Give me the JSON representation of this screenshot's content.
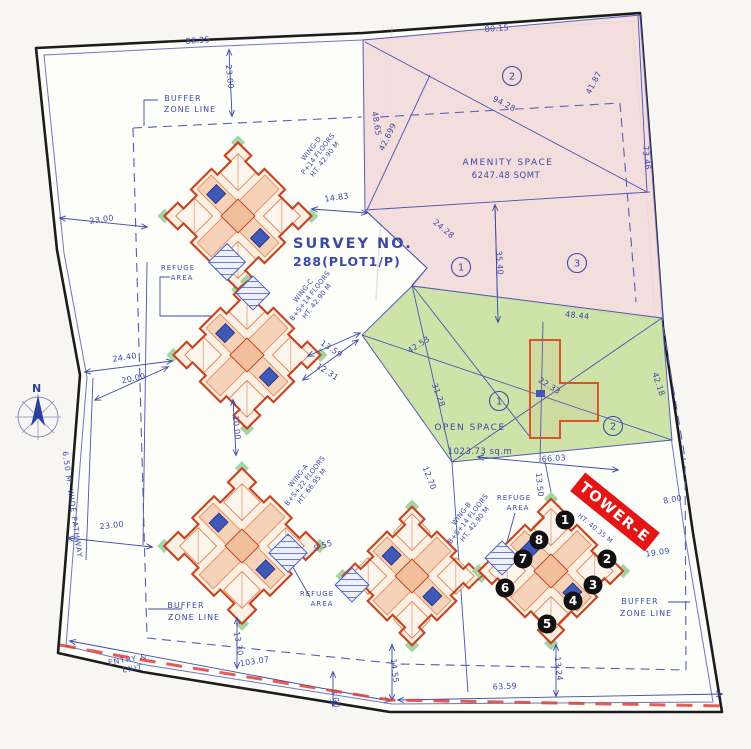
{
  "title": {
    "survey_line1": "SURVEY NO.",
    "survey_line2": "288(PLOT1/P)"
  },
  "north_label": "N",
  "colors": {
    "boundary_black": "#1c1c1c",
    "survey_blue": "#3c4aa5",
    "pink_zone": "#f3dcdc",
    "green_zone": "#cbe2a4",
    "tower_outline": "#c7431f",
    "tower_fill": "#fcefe3",
    "tower_inner": "#e0824f",
    "core_blue": "#4058b8",
    "banner_red": "#e51515",
    "dashed_red": "#e04038",
    "marker_black": "#111111",
    "paper": "#fdfdfa"
  },
  "areas": {
    "amenity": {
      "name": "AMENITY SPACE",
      "value": "6247.48 SQMT",
      "zones": [
        {
          "n": "2",
          "x": 512,
          "y": 76
        },
        {
          "n": "1",
          "x": 461,
          "y": 267
        },
        {
          "n": "3",
          "x": 577,
          "y": 263
        }
      ]
    },
    "open": {
      "name": "OPEN SPACE",
      "value": "1023.73 sq.m",
      "zones": [
        {
          "n": "1",
          "x": 499,
          "y": 401
        },
        {
          "n": "2",
          "x": 613,
          "y": 426
        }
      ]
    }
  },
  "tower_e": {
    "banner": "TOWER-E",
    "sub": "HT. 40.35 M"
  },
  "towers": [
    {
      "id": "wing-d",
      "cx": 238,
      "cy": 216,
      "s": 104
    },
    {
      "id": "wing-c",
      "cx": 247,
      "cy": 355,
      "s": 104
    },
    {
      "id": "wing-a",
      "cx": 242,
      "cy": 546,
      "s": 110
    },
    {
      "id": "wing-b",
      "cx": 412,
      "cy": 576,
      "s": 98
    },
    {
      "id": "wing-e",
      "cx": 551,
      "cy": 571,
      "s": 102
    }
  ],
  "wing_labels": [
    {
      "lines": [
        "WING-D",
        "P+14 FLOORS",
        "HT. 42.90 M"
      ],
      "x": 313,
      "y": 150,
      "r": -52
    },
    {
      "lines": [
        "WING-C",
        "B+S+14 FLOORS",
        "HT. 42.90 M"
      ],
      "x": 305,
      "y": 292,
      "r": -52
    },
    {
      "lines": [
        "WING-A",
        "B+S+22 FLOORS",
        "HT. 66.95 M"
      ],
      "x": 300,
      "y": 477,
      "r": -52
    },
    {
      "lines": [
        "WING-B",
        "B+S+14 FLOORS",
        "HT. 42.90 M"
      ],
      "x": 463,
      "y": 515,
      "r": -52
    }
  ],
  "markers": [
    {
      "n": "1",
      "x": 565,
      "y": 520
    },
    {
      "n": "2",
      "x": 607,
      "y": 559
    },
    {
      "n": "3",
      "x": 593,
      "y": 585
    },
    {
      "n": "4",
      "x": 573,
      "y": 601
    },
    {
      "n": "5",
      "x": 547,
      "y": 624
    },
    {
      "n": "6",
      "x": 505,
      "y": 588
    },
    {
      "n": "7",
      "x": 523,
      "y": 559
    },
    {
      "n": "8",
      "x": 539,
      "y": 540
    }
  ],
  "hatches": [
    {
      "x": 227,
      "y": 262,
      "s": 26
    },
    {
      "x": 253,
      "y": 293,
      "s": 24
    },
    {
      "x": 288,
      "y": 553,
      "s": 27
    },
    {
      "x": 352,
      "y": 585,
      "s": 24
    },
    {
      "x": 502,
      "y": 558,
      "s": 24
    }
  ],
  "dimensions": [
    {
      "t": "80.15",
      "x": 497,
      "y": 31,
      "r": -4
    },
    {
      "t": "88.35",
      "x": 198,
      "y": 43,
      "r": -4
    },
    {
      "t": "23.00",
      "x": 227,
      "y": 77,
      "r": 84
    },
    {
      "t": "94.28",
      "x": 503,
      "y": 106,
      "r": 27
    },
    {
      "t": "41.87",
      "x": 596,
      "y": 84,
      "r": -62
    },
    {
      "t": "42.699",
      "x": 390,
      "y": 138,
      "r": -64
    },
    {
      "t": "48.65",
      "x": 374,
      "y": 124,
      "r": 80
    },
    {
      "t": "73.46",
      "x": 644,
      "y": 158,
      "r": 84
    },
    {
      "t": "14.83",
      "x": 337,
      "y": 200,
      "r": -8
    },
    {
      "t": "35.40",
      "x": 497,
      "y": 263,
      "r": 86
    },
    {
      "t": "24.28",
      "x": 442,
      "y": 231,
      "r": 40
    },
    {
      "t": "48.44",
      "x": 577,
      "y": 318,
      "r": 6
    },
    {
      "t": "23.00",
      "x": 102,
      "y": 222,
      "r": -8
    },
    {
      "t": "24.40",
      "x": 125,
      "y": 360,
      "r": -9
    },
    {
      "t": "20.00",
      "x": 134,
      "y": 381,
      "r": -12
    },
    {
      "t": "23.00",
      "x": 112,
      "y": 528,
      "r": -6
    },
    {
      "t": "13.59",
      "x": 330,
      "y": 351,
      "r": 33
    },
    {
      "t": "12.31",
      "x": 326,
      "y": 374,
      "r": 33
    },
    {
      "t": "42.53",
      "x": 420,
      "y": 347,
      "r": -33
    },
    {
      "t": "31.28",
      "x": 436,
      "y": 396,
      "r": 70
    },
    {
      "t": "22.33",
      "x": 548,
      "y": 388,
      "r": 32
    },
    {
      "t": "12.70",
      "x": 427,
      "y": 479,
      "r": 68
    },
    {
      "t": "66.03",
      "x": 554,
      "y": 461,
      "r": -4
    },
    {
      "t": "13.50",
      "x": 537,
      "y": 485,
      "r": 84
    },
    {
      "t": "8.00",
      "x": 673,
      "y": 502,
      "r": -10
    },
    {
      "t": "19.09",
      "x": 658,
      "y": 555,
      "r": -8
    },
    {
      "t": "9.55",
      "x": 324,
      "y": 548,
      "r": -18
    },
    {
      "t": "10.00",
      "x": 234,
      "y": 428,
      "r": 84
    },
    {
      "t": "103.07",
      "x": 255,
      "y": 664,
      "r": -9
    },
    {
      "t": "13.30",
      "x": 236,
      "y": 644,
      "r": 80
    },
    {
      "t": "8.00",
      "x": 333,
      "y": 699,
      "r": 80
    },
    {
      "t": "14.55",
      "x": 392,
      "y": 671,
      "r": 84
    },
    {
      "t": "13.24",
      "x": 556,
      "y": 669,
      "r": 84
    },
    {
      "t": "63.59",
      "x": 505,
      "y": 689,
      "r": -3
    },
    {
      "t": "42.18",
      "x": 656,
      "y": 385,
      "r": 72
    }
  ],
  "labels": [
    {
      "t": "BUFFER",
      "x": 183,
      "y": 101,
      "s": 8
    },
    {
      "t": "ZONE LINE",
      "x": 190,
      "y": 112,
      "s": 8
    },
    {
      "t": "BUFFER",
      "x": 186,
      "y": 608,
      "s": 8
    },
    {
      "t": "ZONE LINE",
      "x": 194,
      "y": 620,
      "s": 8
    },
    {
      "t": "BUFFER",
      "x": 640,
      "y": 604,
      "s": 8
    },
    {
      "t": "ZONE LINE",
      "x": 646,
      "y": 616,
      "s": 8
    },
    {
      "t": "REFUGE",
      "x": 178,
      "y": 270,
      "s": 7
    },
    {
      "t": "AREA",
      "x": 182,
      "y": 280,
      "s": 7
    },
    {
      "t": "REFUGE",
      "x": 317,
      "y": 596,
      "s": 7
    },
    {
      "t": "AREA",
      "x": 322,
      "y": 606,
      "s": 7
    },
    {
      "t": "REFUGE",
      "x": 514,
      "y": 500,
      "s": 7
    },
    {
      "t": "AREA",
      "x": 518,
      "y": 510,
      "s": 7
    },
    {
      "t": "ENTRY &",
      "x": 128,
      "y": 662,
      "s": 7.5,
      "r": -9
    },
    {
      "t": "EXIT",
      "x": 133,
      "y": 671,
      "s": 7.5,
      "r": -9
    },
    {
      "t": "6.50 M. WIDE PATHWAY",
      "x": 70,
      "y": 505,
      "s": 7.5,
      "r": 82
    }
  ],
  "dim_lines": [
    {
      "x1": 312,
      "y1": 209,
      "x2": 367,
      "y2": 213
    },
    {
      "x1": 60,
      "y1": 218,
      "x2": 147,
      "y2": 227
    },
    {
      "x1": 229,
      "y1": 50,
      "x2": 232,
      "y2": 116
    },
    {
      "x1": 85,
      "y1": 372,
      "x2": 172,
      "y2": 361
    },
    {
      "x1": 95,
      "y1": 400,
      "x2": 168,
      "y2": 367
    },
    {
      "x1": 68,
      "y1": 538,
      "x2": 152,
      "y2": 547
    },
    {
      "x1": 478,
      "y1": 457,
      "x2": 618,
      "y2": 470
    },
    {
      "x1": 398,
      "y1": 700,
      "x2": 722,
      "y2": 694
    },
    {
      "x1": 70,
      "y1": 641,
      "x2": 390,
      "y2": 701
    },
    {
      "x1": 392,
      "y1": 645,
      "x2": 392,
      "y2": 700
    },
    {
      "x1": 333,
      "y1": 672,
      "x2": 333,
      "y2": 706
    },
    {
      "x1": 237,
      "y1": 618,
      "x2": 237,
      "y2": 668
    },
    {
      "x1": 556,
      "y1": 645,
      "x2": 556,
      "y2": 696
    },
    {
      "x1": 233,
      "y1": 400,
      "x2": 236,
      "y2": 455
    },
    {
      "x1": 495,
      "y1": 205,
      "x2": 498,
      "y2": 322
    },
    {
      "x1": 308,
      "y1": 356,
      "x2": 360,
      "y2": 333
    },
    {
      "x1": 303,
      "y1": 380,
      "x2": 358,
      "y2": 340
    }
  ]
}
